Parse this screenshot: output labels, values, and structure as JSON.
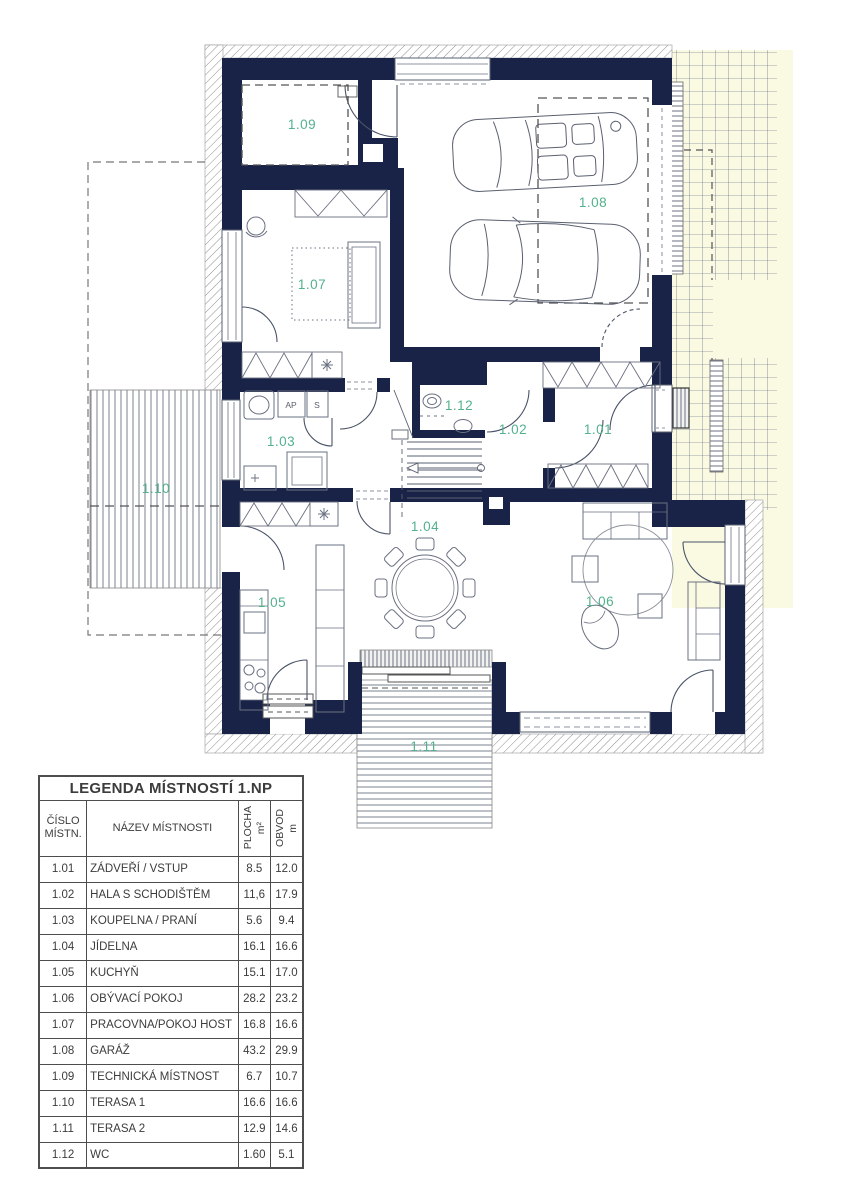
{
  "plan": {
    "rooms": [
      {
        "id": "room-1-01",
        "label": "1.01"
      },
      {
        "id": "room-1-02",
        "label": "1.02"
      },
      {
        "id": "room-1-03",
        "label": "1.03"
      },
      {
        "id": "room-1-04",
        "label": "1.04"
      },
      {
        "id": "room-1-05",
        "label": "1.05"
      },
      {
        "id": "room-1-06",
        "label": "1.06"
      },
      {
        "id": "room-1-07",
        "label": "1.07"
      },
      {
        "id": "room-1-08",
        "label": "1.08"
      },
      {
        "id": "room-1-09",
        "label": "1.09"
      },
      {
        "id": "room-1-10",
        "label": "1.10"
      },
      {
        "id": "room-1-11",
        "label": "1.11"
      },
      {
        "id": "room-1-12",
        "label": "1.12"
      }
    ],
    "fixtures": {
      "ap": "AP",
      "s": "S"
    },
    "colors": {
      "wall": "#192347",
      "room_label_green": "#53b18c",
      "paving_yellow": "#fafae3",
      "hatch_gray": "#8f8f8f"
    }
  },
  "legend": {
    "title": "LEGENDA MÍSTNOSTÍ 1.NP",
    "headers": {
      "number": "ČÍSLO MÍSTN.",
      "name": "NÁZEV MÍSTNOSTI",
      "area_label": "PLOCHA",
      "area_unit": "m²",
      "perimeter_label": "OBVOD",
      "perimeter_unit": "m"
    },
    "rows": [
      {
        "number": "1.01",
        "name": "ZÁDVEŘÍ / VSTUP",
        "area": "8.5",
        "perimeter": "12.0"
      },
      {
        "number": "1.02",
        "name": "HALA S SCHODIŠTĚM",
        "area": "11,6",
        "perimeter": "17.9"
      },
      {
        "number": "1.03",
        "name": "KOUPELNA / PRANÍ",
        "area": "5.6",
        "perimeter": "9.4"
      },
      {
        "number": "1.04",
        "name": "JÍDELNA",
        "area": "16.1",
        "perimeter": "16.6"
      },
      {
        "number": "1.05",
        "name": "KUCHYŇ",
        "area": "15.1",
        "perimeter": "17.0"
      },
      {
        "number": "1.06",
        "name": "OBÝVACÍ POKOJ",
        "area": "28.2",
        "perimeter": "23.2"
      },
      {
        "number": "1.07",
        "name": "PRACOVNA/POKOJ HOST",
        "area": "16.8",
        "perimeter": "16.6"
      },
      {
        "number": "1.08",
        "name": "GARÁŽ",
        "area": "43.2",
        "perimeter": "29.9"
      },
      {
        "number": "1.09",
        "name": "TECHNICKÁ MÍSTNOST",
        "area": "6.7",
        "perimeter": "10.7"
      },
      {
        "number": "1.10",
        "name": "TERASA 1",
        "area": "16.6",
        "perimeter": "16.6"
      },
      {
        "number": "1.11",
        "name": "TERASA 2",
        "area": "12.9",
        "perimeter": "14.6"
      },
      {
        "number": "1.12",
        "name": "WC",
        "area": "1.60",
        "perimeter": "5.1"
      }
    ]
  }
}
